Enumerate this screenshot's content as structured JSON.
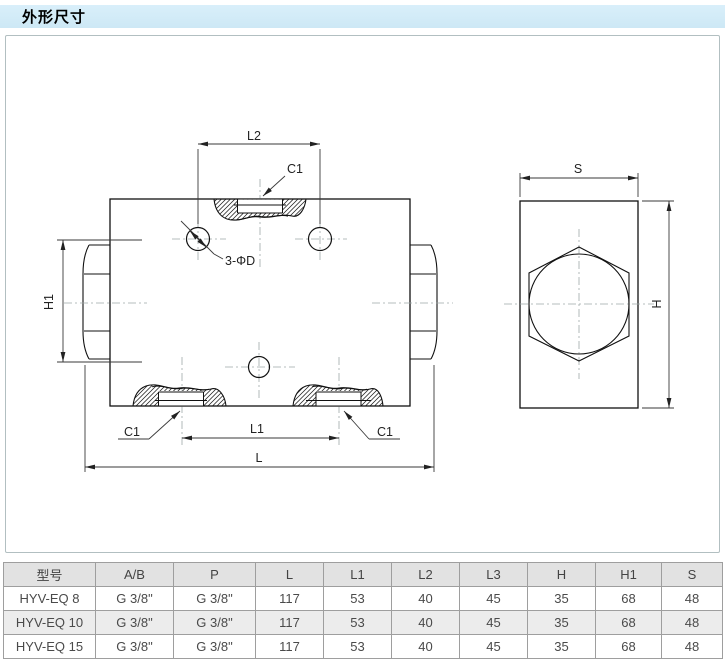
{
  "page": {
    "title": "外形尺寸"
  },
  "drawing": {
    "labels": {
      "l2": "L2",
      "c1_top": "C1",
      "holes": "3-ΦD",
      "h1": "H1",
      "c1_bottom_left": "C1",
      "l1": "L1",
      "c1_bottom_right": "C1",
      "l": "L",
      "s": "S",
      "h": "H"
    }
  },
  "table": {
    "columns": [
      "型号",
      "A/B",
      "P",
      "L",
      "L1",
      "L2",
      "L3",
      "H",
      "H1",
      "S"
    ],
    "rows": [
      {
        "cells": [
          "HYV-EQ 8",
          "G 3/8\"",
          "G 3/8\"",
          "117",
          "53",
          "40",
          "45",
          "35",
          "68",
          "48"
        ]
      },
      {
        "cells": [
          "HYV-EQ 10",
          "G 3/8\"",
          "G 3/8\"",
          "117",
          "53",
          "40",
          "45",
          "35",
          "68",
          "48"
        ]
      },
      {
        "cells": [
          "HYV-EQ 15",
          "G 3/8\"",
          "G 3/8\"",
          "117",
          "53",
          "40",
          "45",
          "35",
          "68",
          "48"
        ]
      }
    ]
  },
  "colors": {
    "header_bar_top": "#d9effa",
    "header_bar_bottom": "#cde8f5",
    "panel_border": "#b2bfc1",
    "table_border": "#9e9e9e",
    "table_header_bg": "#e2e2e2",
    "table_alt_row_bg": "#ececec",
    "line_color": "#111111",
    "dim_color": "#3a3a3a",
    "centerline_color": "#9fa8a8"
  }
}
